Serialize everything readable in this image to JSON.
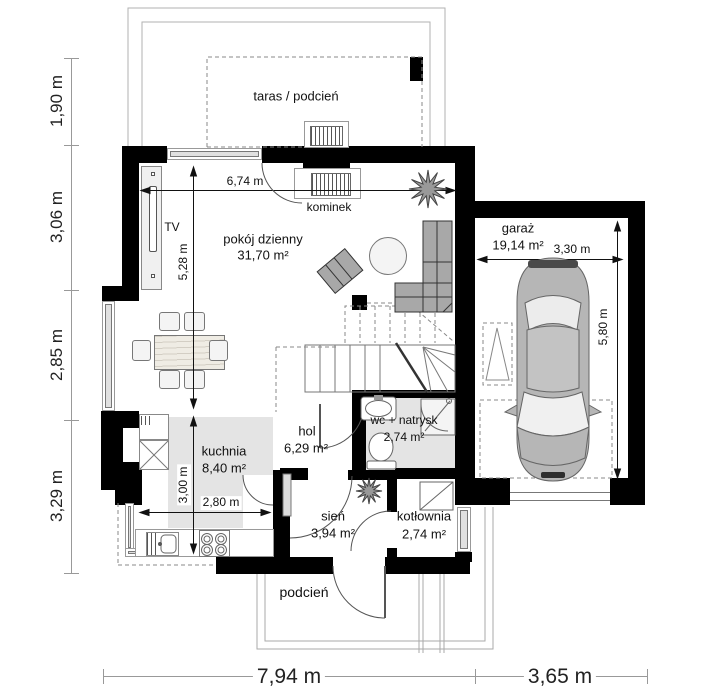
{
  "rooms": {
    "taras": {
      "name": "taras / podcień"
    },
    "pokoj": {
      "name": "pokój dzienny",
      "area": "31,70 m²"
    },
    "kominek": {
      "name": "kominek"
    },
    "garaz": {
      "name": "garaż",
      "area": "19,14 m²"
    },
    "kuchnia": {
      "name": "kuchnia",
      "area": "8,40 m²"
    },
    "hol": {
      "name": "hol",
      "area": "6,29 m²"
    },
    "wc": {
      "name": "wc + natrysk",
      "area": "2,74 m²"
    },
    "sien": {
      "name": "sień",
      "area": "3,94 m²"
    },
    "kotlownia": {
      "name": "kotłownia",
      "area": "2,74 m²"
    },
    "podcien": {
      "name": "podcień"
    },
    "tv": {
      "name": "TV"
    }
  },
  "dims": {
    "left": [
      "1,90 m",
      "3,06 m",
      "2,85 m",
      "3,29 m"
    ],
    "bottom": [
      "7,94 m",
      "3,65 m"
    ],
    "interior": {
      "living_w": "6,74 m",
      "living_h": "5,28 m",
      "kitchen_h": "3,00 m",
      "kitchen_w": "2,80 m",
      "garage_w": "3,30 m",
      "garage_h": "5,80 m"
    }
  },
  "colors": {
    "wall": "#000000",
    "room_shade": "#e4e4e4",
    "furniture": "#a8a8a8",
    "dimension_line": "#999999"
  }
}
